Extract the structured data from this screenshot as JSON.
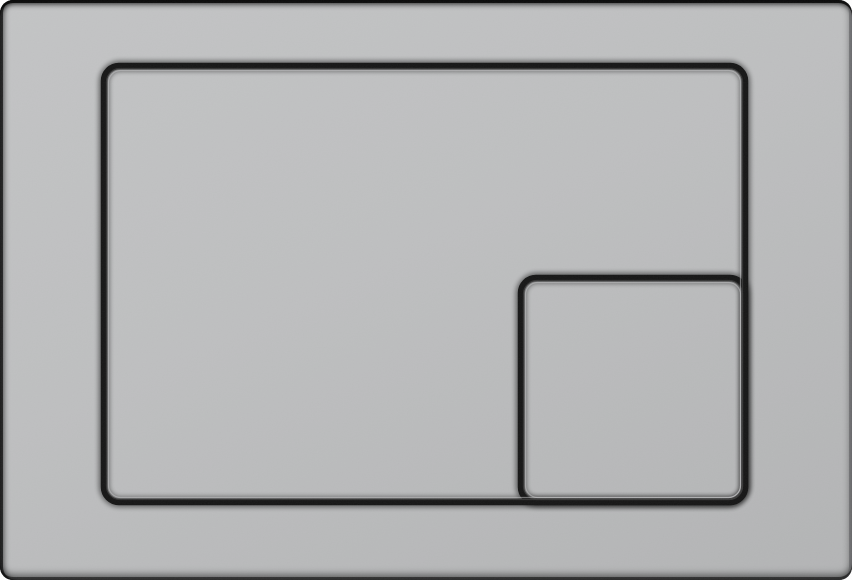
{
  "product": {
    "name": "dual-flush actuator plate",
    "finish": "matte gray plastic with black recessed outlines",
    "buttons": [
      {
        "id": "full-flush",
        "shape": "large rounded rectangle",
        "label": "full flush button"
      },
      {
        "id": "half-flush",
        "shape": "small rounded square",
        "label": "half flush button"
      }
    ]
  },
  "colors": {
    "surface-light": "#c3c4c5",
    "surface": "#bebfc0",
    "surface-dark": "#b3b4b5",
    "groove": "#161616",
    "groove-soft": "#000000",
    "groove-inner": "#3c3c3c",
    "face-edge": "#cdcecf",
    "rim-top": "#0f0f0f",
    "rim-left": "#1d1d1d",
    "rim-bottom": "#252525",
    "rim-right": "#6e6f70"
  }
}
